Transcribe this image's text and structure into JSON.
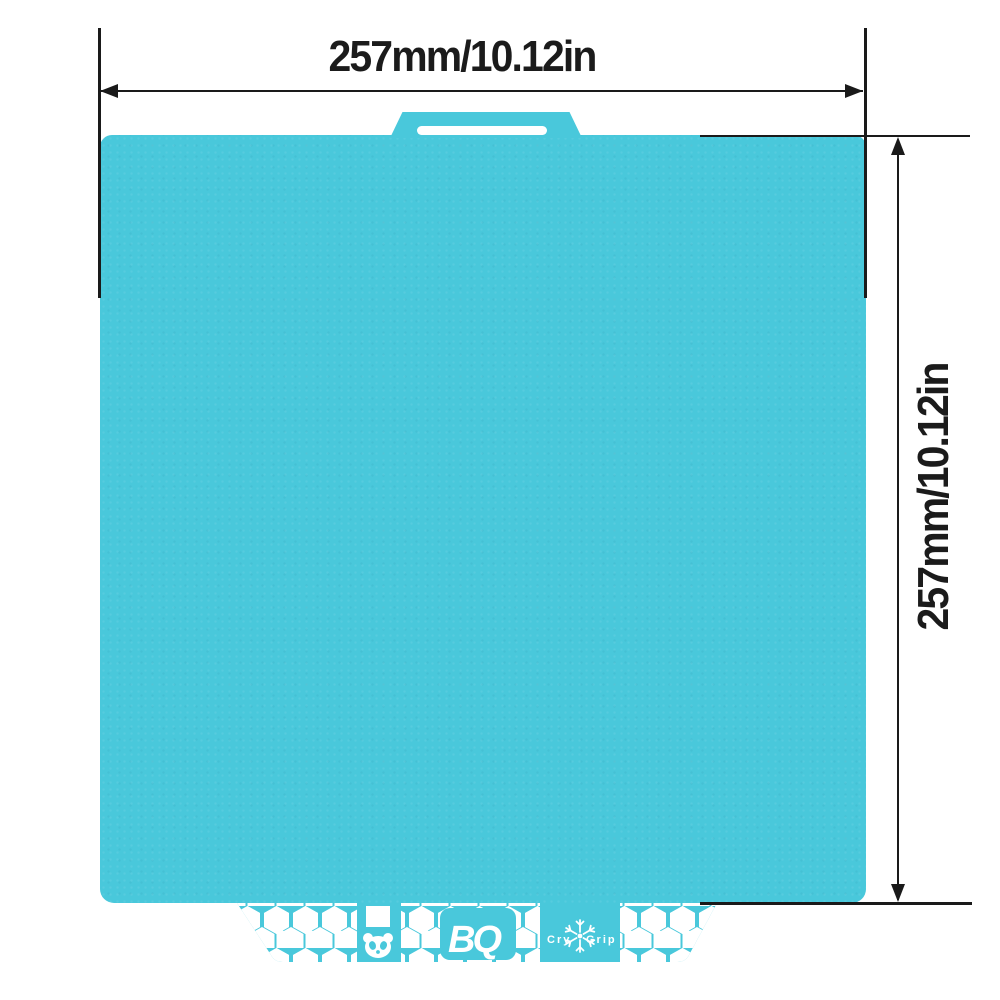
{
  "dimensions": {
    "horizontal": {
      "label": "257mm/10.12in"
    },
    "vertical": {
      "label": "257mm/10.12in"
    }
  },
  "plate": {
    "color": "#49C8DB",
    "cutout_color": "#FFFFFF",
    "branding": {
      "logo_text": "BQ",
      "grip_prefix": "Cry",
      "grip_suffix": "Grip",
      "icons": {
        "snowflake": "snowflake-icon",
        "panda": "panda-icon",
        "square": "square-cutout"
      }
    }
  },
  "colors": {
    "line": "#1A1A1A",
    "text": "#1B1B1B",
    "background": "#FFFFFF"
  }
}
